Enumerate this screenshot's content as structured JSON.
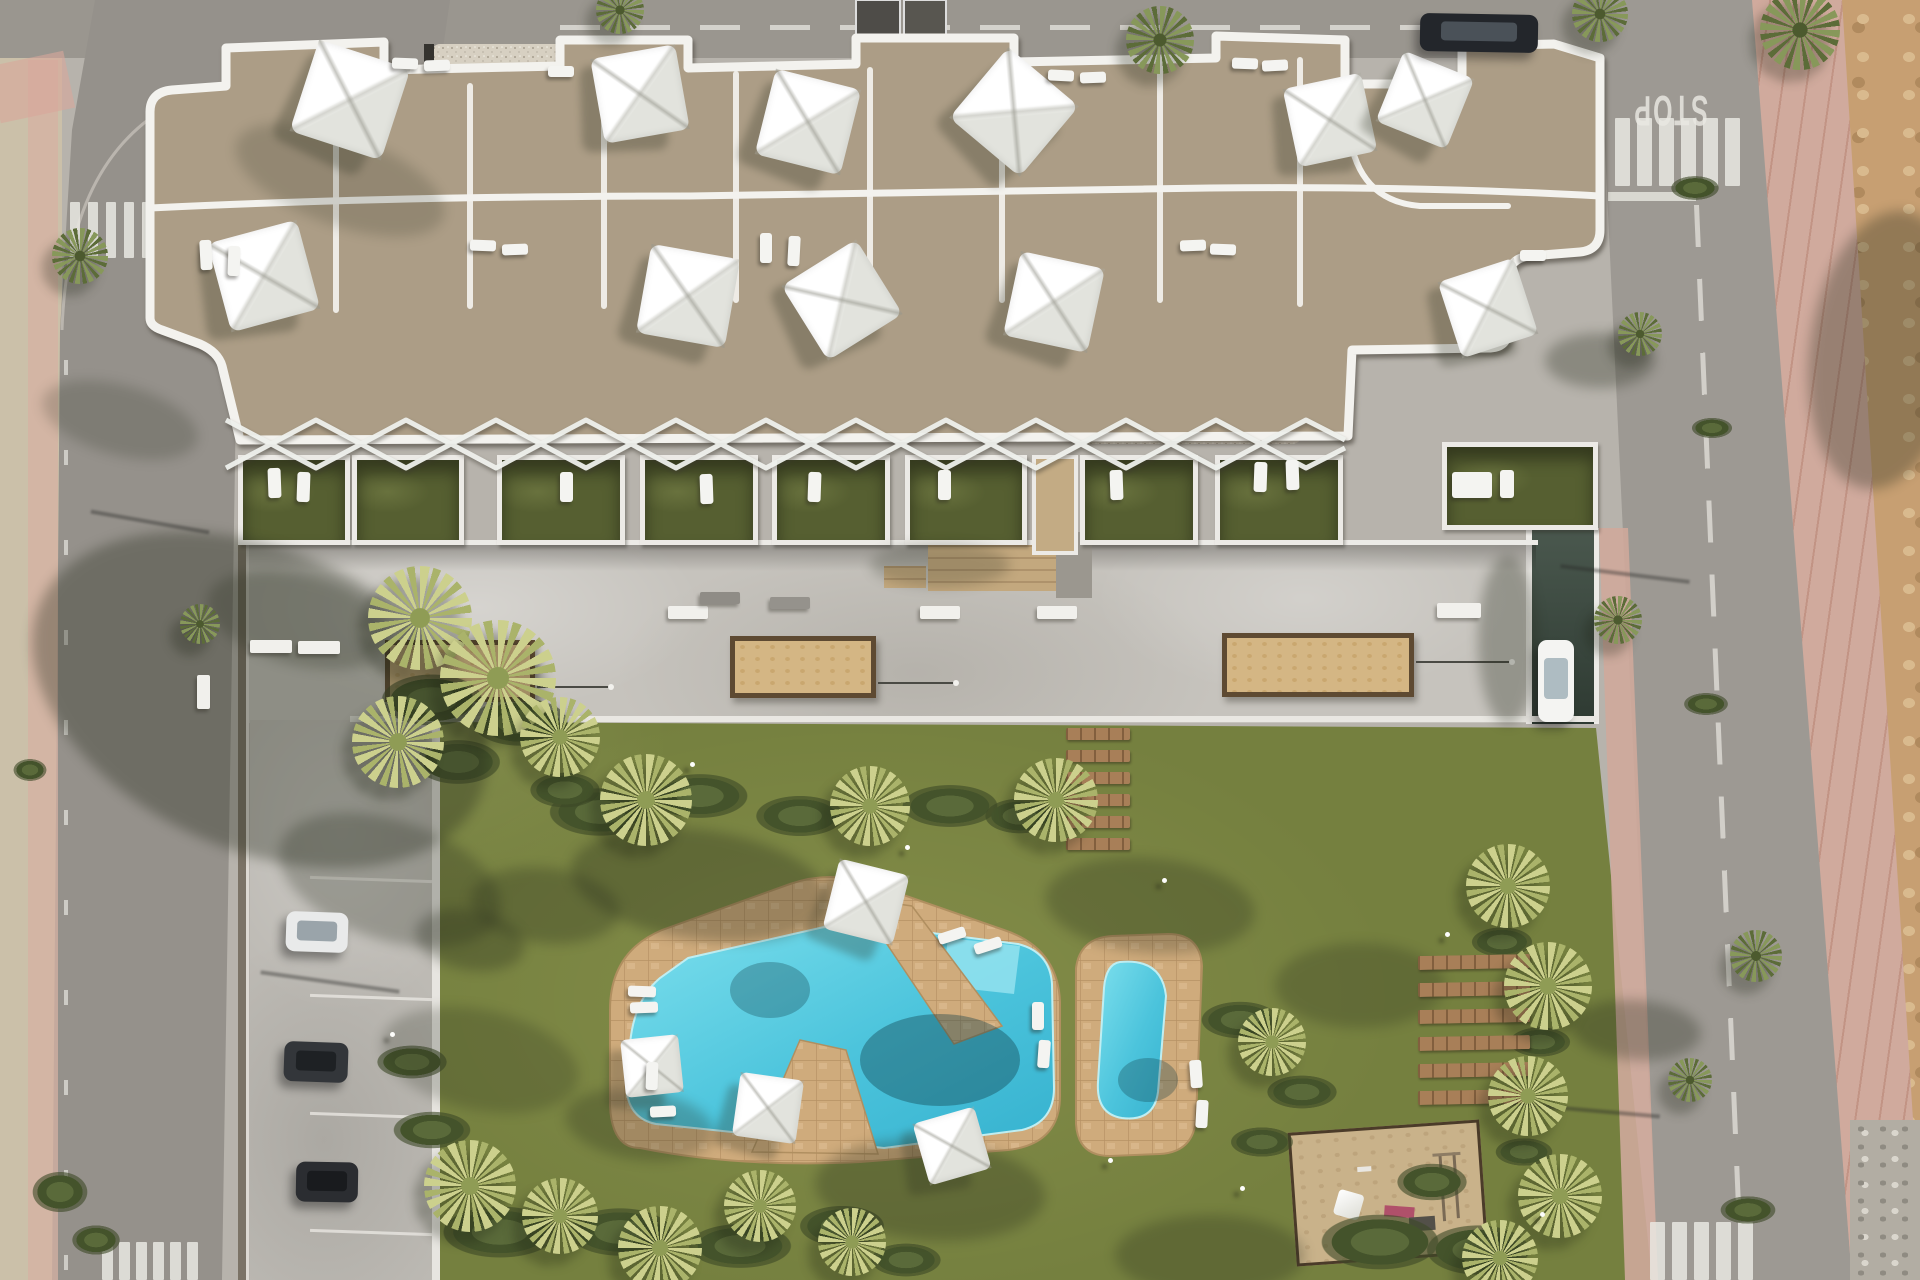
{
  "title": "Aerial render of residential complex with pool garden",
  "road": {
    "stop_text": "STOP"
  },
  "palette": {
    "asphalt": "#9a968f",
    "concrete": "#c6c3bd",
    "sand_sidewalk": "#cbc0a9",
    "pink_sidewalk": "#d0aa9d",
    "dirt": "#c79f72",
    "roof_tan": "#ac9d86",
    "roof_dark": "#6e675b",
    "gravel": "#d7d0c2",
    "ribbon_white": "#f3f2ee",
    "grass_cell": "#565f31",
    "lawn": "#75803f",
    "pool_blue": "#4fc6dd",
    "deck_tan": "#cfab7c",
    "planter_sand": "#d4b684",
    "wood_plank": "#a87f58"
  },
  "scene": {
    "parasols": [
      [
        350,
        100,
        96,
        18
      ],
      [
        640,
        94,
        86,
        -10
      ],
      [
        808,
        122,
        88,
        14
      ],
      [
        1014,
        112,
        92,
        40
      ],
      [
        1330,
        120,
        80,
        -12
      ],
      [
        1425,
        100,
        76,
        22
      ],
      [
        264,
        276,
        92,
        -15
      ],
      [
        688,
        296,
        90,
        10
      ],
      [
        842,
        300,
        88,
        -32
      ],
      [
        1054,
        302,
        86,
        12
      ],
      [
        1488,
        308,
        80,
        -18
      ],
      [
        866,
        902,
        72,
        14
      ],
      [
        652,
        1066,
        58,
        -6
      ],
      [
        768,
        1108,
        64,
        8
      ],
      [
        952,
        1146,
        64,
        -16
      ]
    ],
    "loungers": [
      [
        392,
        58,
        26,
        11,
        2
      ],
      [
        424,
        60,
        26,
        11,
        -2
      ],
      [
        548,
        66,
        26,
        11,
        0
      ],
      [
        1048,
        70,
        26,
        11,
        3
      ],
      [
        1080,
        72,
        26,
        11,
        -2
      ],
      [
        1232,
        58,
        26,
        11,
        2
      ],
      [
        1262,
        60,
        26,
        11,
        -3
      ],
      [
        200,
        240,
        12,
        30,
        -3
      ],
      [
        228,
        246,
        12,
        30,
        2
      ],
      [
        470,
        240,
        26,
        11,
        2
      ],
      [
        502,
        244,
        26,
        11,
        -2
      ],
      [
        760,
        233,
        12,
        30,
        0
      ],
      [
        788,
        236,
        12,
        30,
        3
      ],
      [
        1180,
        240,
        26,
        11,
        -2
      ],
      [
        1210,
        244,
        26,
        11,
        2
      ],
      [
        1520,
        250,
        26,
        11,
        0
      ],
      [
        268,
        468,
        13,
        30,
        -2
      ],
      [
        297,
        472,
        13,
        30,
        2
      ],
      [
        560,
        472,
        13,
        30,
        0
      ],
      [
        700,
        474,
        13,
        30,
        -2
      ],
      [
        808,
        472,
        13,
        30,
        2
      ],
      [
        938,
        470,
        13,
        30,
        0
      ],
      [
        1110,
        470,
        13,
        30,
        -2
      ],
      [
        1254,
        462,
        13,
        30,
        2
      ],
      [
        1286,
        460,
        13,
        30,
        -2
      ],
      [
        1452,
        472,
        40,
        26,
        0
      ],
      [
        1500,
        470,
        14,
        28,
        0
      ],
      [
        938,
        930,
        28,
        11,
        -18
      ],
      [
        974,
        940,
        28,
        11,
        -18
      ],
      [
        628,
        986,
        28,
        11,
        2
      ],
      [
        630,
        1002,
        28,
        11,
        -2
      ],
      [
        646,
        1062,
        12,
        28,
        2
      ],
      [
        650,
        1106,
        26,
        11,
        -3
      ],
      [
        1032,
        1002,
        12,
        28,
        0
      ],
      [
        1038,
        1040,
        12,
        28,
        4
      ],
      [
        1190,
        1060,
        12,
        28,
        -4
      ],
      [
        1196,
        1100,
        12,
        28,
        3
      ]
    ],
    "benches": [
      [
        250,
        640,
        42,
        13,
        0
      ],
      [
        298,
        641,
        42,
        13,
        0
      ],
      [
        197,
        675,
        13,
        34,
        0
      ],
      [
        668,
        606,
        40,
        13,
        0
      ],
      [
        920,
        606,
        40,
        13,
        0
      ],
      [
        1037,
        606,
        40,
        13,
        0
      ],
      [
        1437,
        603,
        44,
        15,
        0
      ],
      [
        700,
        592,
        40,
        12,
        0,
        "#8f8c86"
      ],
      [
        770,
        597,
        40,
        12,
        0,
        "#95928c"
      ]
    ],
    "planters": [
      [
        385,
        640,
        150,
        62
      ],
      [
        730,
        636,
        146,
        62
      ],
      [
        1222,
        633,
        192,
        64
      ]
    ],
    "rods": [
      [
        537,
        686,
        74
      ],
      [
        878,
        682,
        78
      ],
      [
        1416,
        661,
        96
      ]
    ],
    "plank_groups": [
      {
        "x": 1066,
        "y": 728,
        "w": 64,
        "h": 12,
        "gap": 10,
        "n": 6,
        "rot": 0
      },
      {
        "x": 1418,
        "y": 955,
        "w": 112,
        "h": 14,
        "gap": 13,
        "n": 6,
        "rot": -1
      }
    ],
    "cars": [
      {
        "x": 1420,
        "y": 14,
        "w": 118,
        "h": 38,
        "rot": 1,
        "body": "#23262b",
        "glass": "#4a5158"
      },
      {
        "x": 1538,
        "y": 640,
        "w": 36,
        "h": 82,
        "rot": 0,
        "body": "#f4f4f2",
        "glass": "#aebcc2"
      },
      {
        "x": 286,
        "y": 912,
        "w": 62,
        "h": 40,
        "rot": 2,
        "body": "#e9eaea",
        "glass": "#9aa4aa"
      },
      {
        "x": 284,
        "y": 1042,
        "w": 64,
        "h": 40,
        "rot": 2,
        "body": "#33363a",
        "glass": "#1e2124"
      },
      {
        "x": 296,
        "y": 1162,
        "w": 62,
        "h": 40,
        "rot": 1,
        "body": "#2b2d31",
        "glass": "#191b1e"
      }
    ],
    "garden_cells": [
      {
        "x": 238,
        "y": 455,
        "w": 112,
        "h": 90
      },
      {
        "x": 352,
        "y": 455,
        "w": 112,
        "h": 90
      },
      {
        "x": 497,
        "y": 455,
        "w": 128,
        "h": 90
      },
      {
        "x": 640,
        "y": 455,
        "w": 118,
        "h": 90
      },
      {
        "x": 772,
        "y": 455,
        "w": 118,
        "h": 90
      },
      {
        "x": 905,
        "y": 455,
        "w": 122,
        "h": 90
      },
      {
        "x": 1032,
        "y": 455,
        "w": 46,
        "h": 100,
        "grass": false
      },
      {
        "x": 1080,
        "y": 455,
        "w": 118,
        "h": 90
      },
      {
        "x": 1215,
        "y": 455,
        "w": 128,
        "h": 90
      },
      {
        "x": 1442,
        "y": 442,
        "w": 156,
        "h": 88
      }
    ],
    "palms": [
      [
        420,
        618,
        52,
        "y"
      ],
      [
        498,
        678,
        58,
        "y"
      ],
      [
        398,
        742,
        46,
        "y"
      ],
      [
        560,
        737,
        40,
        "y"
      ],
      [
        646,
        800,
        46,
        "y"
      ],
      [
        870,
        806,
        40,
        "y"
      ],
      [
        1056,
        800,
        42,
        "y"
      ],
      [
        470,
        1186,
        46,
        "y"
      ],
      [
        560,
        1216,
        38,
        "y"
      ],
      [
        660,
        1248,
        42,
        "y"
      ],
      [
        760,
        1206,
        36,
        "y"
      ],
      [
        852,
        1242,
        34,
        "y"
      ],
      [
        1272,
        1042,
        34,
        "y"
      ],
      [
        1508,
        886,
        42,
        "y"
      ],
      [
        1548,
        986,
        44,
        "y"
      ],
      [
        1528,
        1096,
        40,
        "y"
      ],
      [
        1560,
        1196,
        42,
        "y"
      ],
      [
        1500,
        1258,
        38,
        "y"
      ],
      [
        1600,
        14,
        28,
        "g"
      ],
      [
        1800,
        30,
        40,
        "g"
      ],
      [
        80,
        256,
        28,
        "g"
      ],
      [
        200,
        624,
        20,
        "g"
      ],
      [
        1618,
        620,
        24,
        "g"
      ],
      [
        1640,
        334,
        22,
        "g"
      ],
      [
        1756,
        956,
        26,
        "g"
      ],
      [
        1690,
        1080,
        22,
        "g"
      ],
      [
        1160,
        40,
        34,
        "g"
      ],
      [
        620,
        10,
        24,
        "g"
      ]
    ],
    "shrubs": [
      [
        600,
        812,
        55,
        26
      ],
      [
        700,
        796,
        52,
        24
      ],
      [
        800,
        816,
        48,
        22
      ],
      [
        950,
        806,
        52,
        23
      ],
      [
        1020,
        816,
        38,
        19
      ],
      [
        565,
        790,
        38,
        19
      ],
      [
        432,
        700,
        55,
        28
      ],
      [
        520,
        722,
        52,
        26
      ],
      [
        458,
        762,
        46,
        24
      ],
      [
        500,
        1232,
        62,
        28
      ],
      [
        620,
        1232,
        56,
        26
      ],
      [
        740,
        1246,
        56,
        24
      ],
      [
        842,
        1226,
        46,
        22
      ],
      [
        906,
        1260,
        38,
        18
      ],
      [
        432,
        1130,
        42,
        20
      ],
      [
        412,
        1062,
        38,
        18
      ],
      [
        1240,
        1020,
        42,
        20
      ],
      [
        1302,
        1092,
        38,
        18
      ],
      [
        1262,
        1142,
        34,
        16
      ],
      [
        1380,
        1242,
        64,
        30
      ],
      [
        1478,
        1250,
        56,
        27
      ],
      [
        1432,
        1182,
        38,
        20
      ],
      [
        1502,
        942,
        33,
        16
      ],
      [
        1540,
        1042,
        33,
        16
      ],
      [
        1524,
        1152,
        31,
        15
      ],
      [
        1695,
        188,
        26,
        13
      ],
      [
        1712,
        428,
        22,
        11
      ],
      [
        1706,
        704,
        24,
        12
      ],
      [
        1748,
        1210,
        30,
        15
      ],
      [
        60,
        1192,
        30,
        22
      ],
      [
        96,
        1240,
        26,
        16
      ],
      [
        30,
        770,
        18,
        12
      ]
    ],
    "shadow_blobs": [
      [
        260,
        700,
        480,
        300,
        24,
        0.34
      ],
      [
        300,
        620,
        190,
        90,
        14,
        0.25
      ],
      [
        390,
        880,
        230,
        120,
        18,
        0.27
      ],
      [
        480,
        1060,
        200,
        100,
        12,
        0.22
      ],
      [
        940,
        565,
        140,
        44,
        0,
        0.22
      ],
      [
        1508,
        640,
        60,
        170,
        0,
        0.3
      ],
      [
        700,
        885,
        260,
        110,
        8,
        0.3
      ],
      [
        1150,
        905,
        210,
        95,
        5,
        0.26
      ],
      [
        1360,
        985,
        170,
        85,
        0,
        0.24
      ],
      [
        930,
        1190,
        230,
        100,
        4,
        0.28
      ],
      [
        1210,
        1255,
        190,
        80,
        0,
        0.26
      ],
      [
        545,
        905,
        150,
        75,
        6,
        0.28
      ],
      [
        640,
        1125,
        150,
        70,
        8,
        0.26
      ],
      [
        470,
        940,
        110,
        60,
        10,
        0.3
      ],
      [
        1600,
        360,
        110,
        55,
        0,
        0.3
      ],
      [
        1636,
        1030,
        130,
        60,
        4,
        0.3
      ],
      [
        1885,
        350,
        150,
        280,
        8,
        0.32
      ],
      [
        340,
        180,
        220,
        90,
        20,
        0.18
      ],
      [
        120,
        420,
        160,
        70,
        15,
        0.2
      ]
    ],
    "pole_shadows": [
      [
        1560,
        572,
        130,
        7
      ],
      [
        1510,
        1108,
        150,
        5
      ],
      [
        90,
        520,
        120,
        10
      ],
      [
        260,
        980,
        140,
        8
      ]
    ],
    "lights": [
      [
        905,
        845
      ],
      [
        1162,
        878
      ],
      [
        390,
        1032
      ],
      [
        1240,
        1186
      ],
      [
        1445,
        932
      ],
      [
        1540,
        1212
      ],
      [
        690,
        762
      ],
      [
        1108,
        1158
      ]
    ],
    "parking_lines": [
      [
        310,
        878,
        122,
        2
      ],
      [
        310,
        996,
        122,
        2
      ],
      [
        310,
        1114,
        122,
        2
      ],
      [
        310,
        1231,
        122,
        2
      ]
    ],
    "road_ticks_x": 64,
    "road_ticks_y": [
      360,
      450,
      540,
      630,
      720,
      810,
      900,
      990,
      1080,
      1170,
      1255
    ],
    "zebras": [
      {
        "x": 1615,
        "y": 118,
        "n": 6,
        "w": 15,
        "h": 68,
        "gap": 7
      },
      {
        "x": 1650,
        "y": 1222,
        "n": 5,
        "w": 15,
        "h": 58,
        "gap": 7
      },
      {
        "x": 102,
        "y": 1242,
        "n": 6,
        "w": 11,
        "h": 38,
        "gap": 6
      },
      {
        "x": 70,
        "y": 202,
        "n": 6,
        "w": 10,
        "h": 56,
        "gap": 8
      }
    ]
  }
}
